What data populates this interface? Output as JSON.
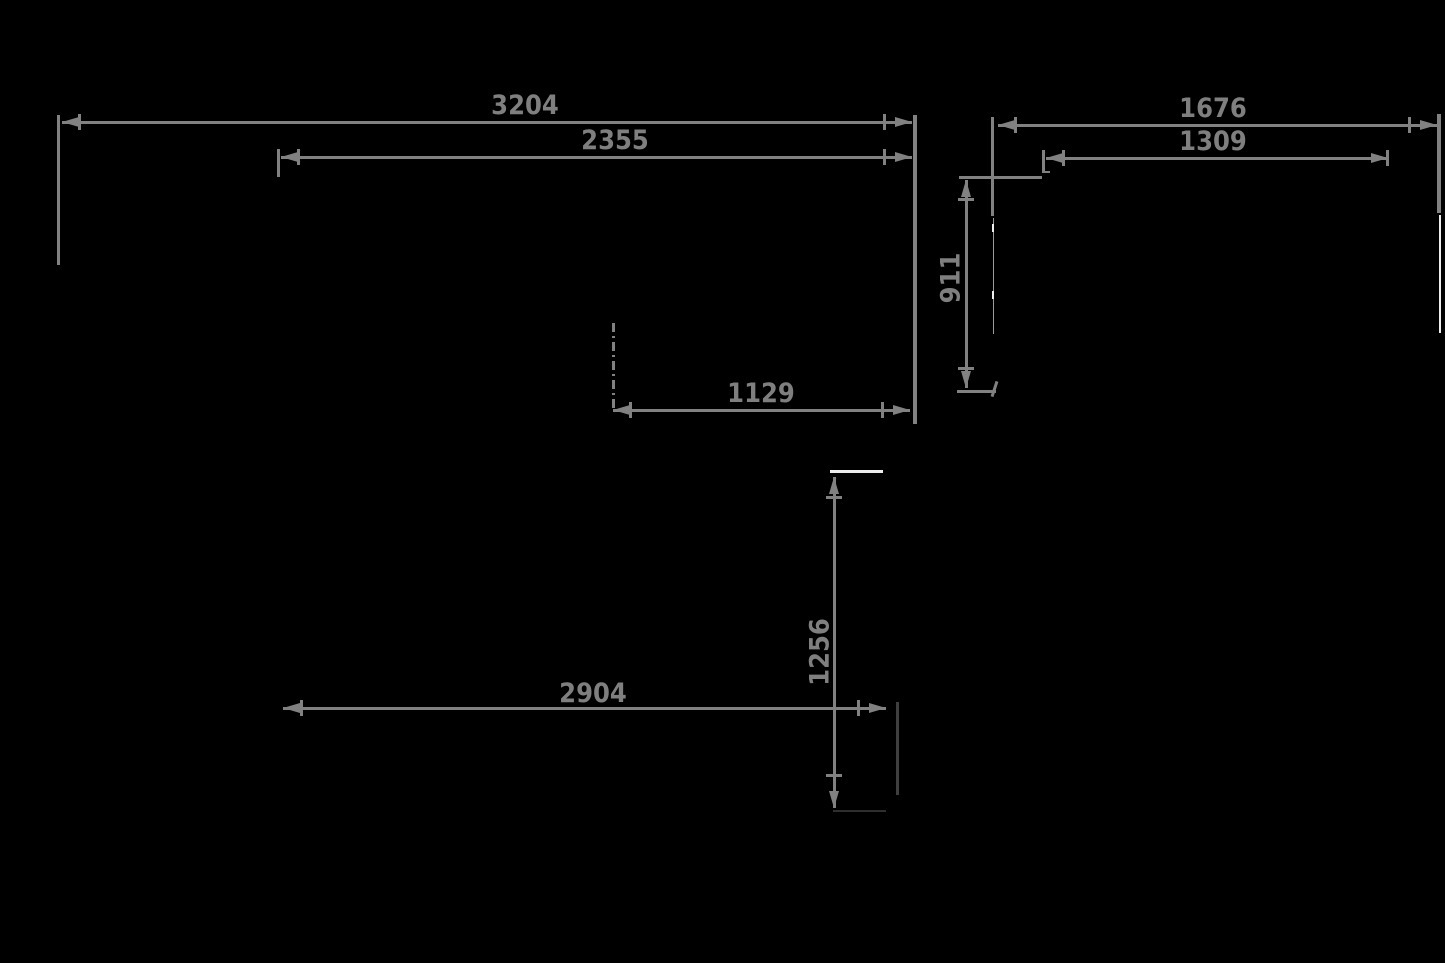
{
  "meta": {
    "type": "technical-dimension-drawing",
    "background_color": "#000000"
  },
  "style": {
    "dimension_line_color": "#818181",
    "label_color": "#7f7f7f",
    "dark_geometry_color": "#3f3f3f",
    "white_geometry_color": "#ededed"
  },
  "dimensions": {
    "plan_overall_width": "3204",
    "plan_inner_width": "2355",
    "plan_opening_width": "1129",
    "side_overall_width": "1676",
    "side_inner_width": "1309",
    "side_depth": "911",
    "front_height": "1256",
    "front_width": "2904"
  }
}
